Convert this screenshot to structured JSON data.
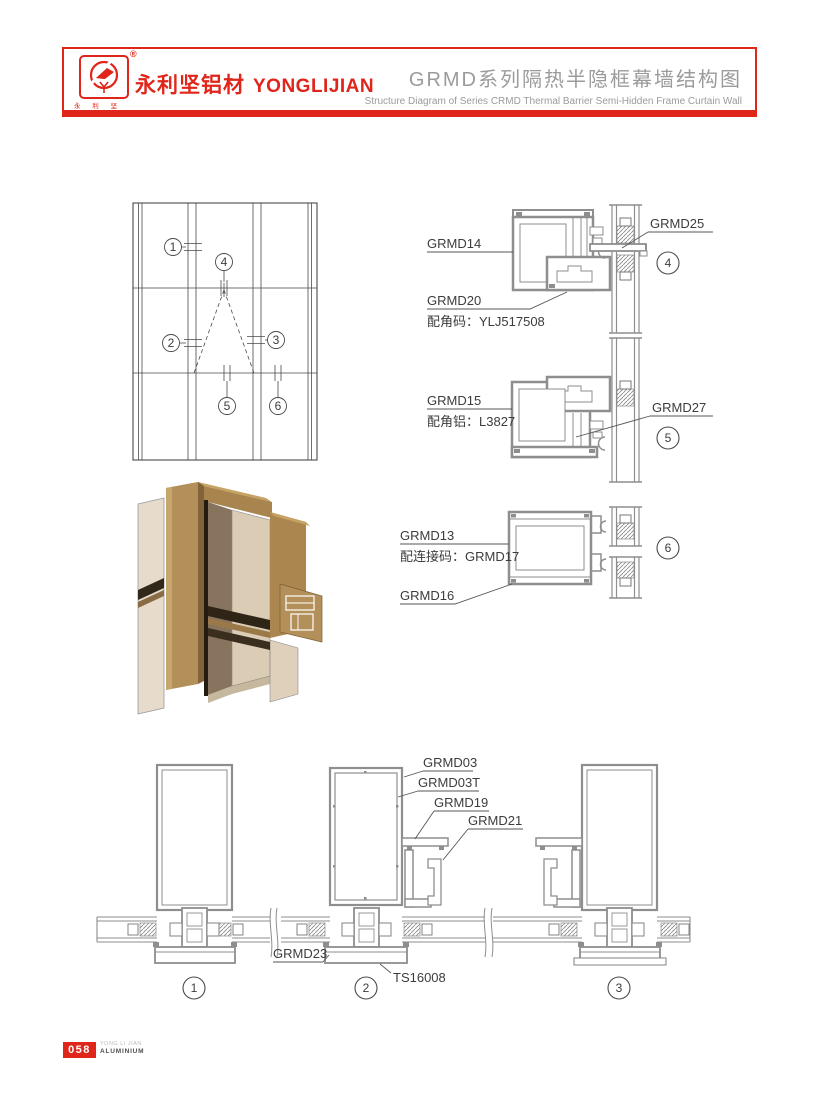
{
  "header": {
    "logo_chars": "永 利 坚",
    "registered": "®",
    "brand_cn": "永利坚铝材",
    "brand_en": "YONGLIJIAN",
    "title_cn": "GRMD系列隔热半隐框幕墙结构图",
    "title_en": "Structure Diagram of Series CRMD Thermal Barrier Semi-Hidden Frame Curtain Wall"
  },
  "colors": {
    "accent_red": "#e0251b",
    "drawing_gray": "#8e8e8e",
    "title_gray": "#9b9b9b",
    "bronze": "#b3905a"
  },
  "elevation": {
    "callouts": {
      "c1": "1",
      "c2": "2",
      "c3": "3",
      "c4": "4",
      "c5": "5",
      "c6": "6"
    }
  },
  "right_details": {
    "labels": {
      "grmd14": "GRMD14",
      "grmd20": "GRMD20",
      "grmd20_note": "配角码：YLJ517508",
      "grmd25": "GRMD25",
      "grmd15": "GRMD15",
      "grmd15_note": "配角铝：L3827",
      "grmd27": "GRMD27",
      "grmd13": "GRMD13",
      "grmd13_note": "配连接码：GRMD17",
      "grmd16": "GRMD16"
    },
    "callouts": {
      "c4": "4",
      "c5": "5",
      "c6": "6"
    }
  },
  "bottom_details": {
    "labels": {
      "grmd03": "GRMD03",
      "grmd03t": "GRMD03T",
      "grmd19": "GRMD19",
      "grmd21": "GRMD21",
      "grmd23": "GRMD23",
      "ts16008": "TS16008"
    },
    "callouts": {
      "c1": "1",
      "c2": "2",
      "c3": "3"
    }
  },
  "footer": {
    "page_number": "058",
    "company_line1": "YONG LI JIAN",
    "company_line2": "ALUMINIUM"
  }
}
